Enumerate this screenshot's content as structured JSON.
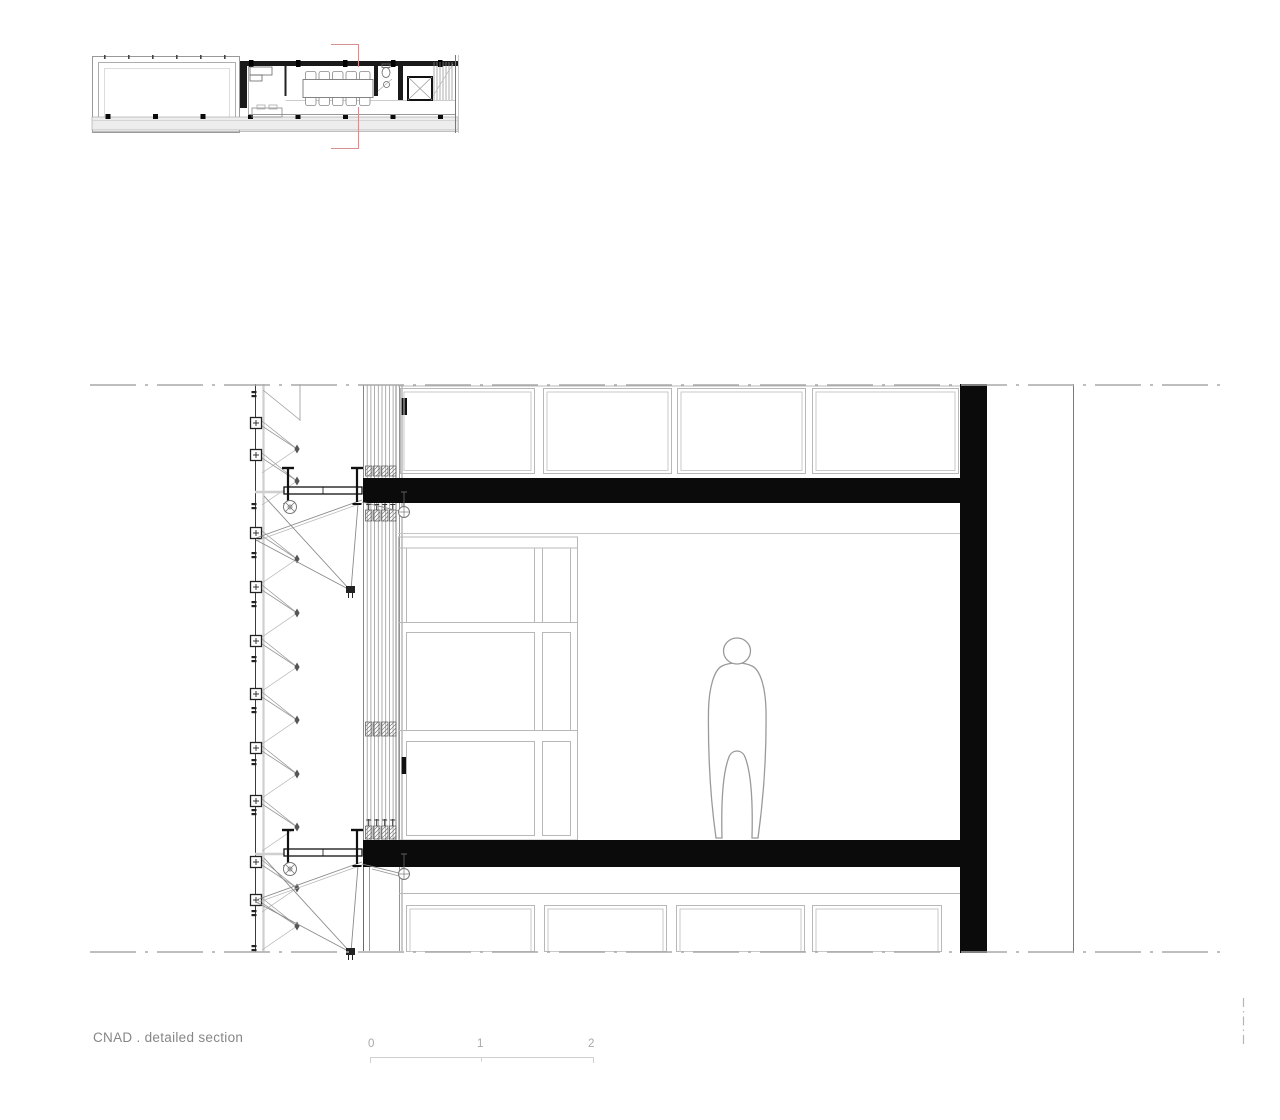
{
  "document": {
    "title": "CNAD . detailed section"
  },
  "scale_bar": {
    "ticks": [
      "0",
      "1",
      "2"
    ]
  },
  "colors": {
    "background": "#ffffff",
    "solid_cut_black": "#0b0b0b",
    "dark_line": "#1a1a1a",
    "mid_line": "#8a8a8a",
    "light_line": "#bcbcbc",
    "very_light_line": "#d6d6d6",
    "dashdot_gray": "#a8a8a8",
    "section_mark_red": "#d49090",
    "title_gray": "#868686",
    "scale_gray": "#a8a8a8"
  }
}
